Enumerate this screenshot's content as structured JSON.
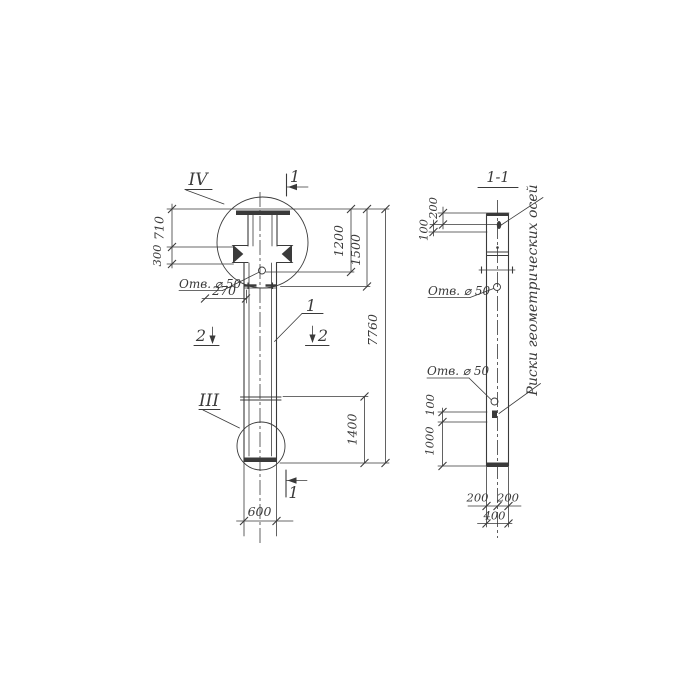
{
  "front_view": {
    "detail_marker_top": "IV",
    "detail_marker_bottom": "III",
    "section_cut_top": "1",
    "section_cut_bottom": "1",
    "section_cut_left": "2",
    "section_cut_right": "2",
    "part_mark": "1",
    "hole_label": "Отв. ⌀ 50",
    "dim_710": "710",
    "dim_300": "300",
    "dim_270": "270",
    "dim_1200": "1200",
    "dim_1500": "1500",
    "dim_7760": "7760",
    "dim_1400": "1400",
    "dim_600": "600"
  },
  "section_view": {
    "title": "1-1",
    "hole_label_upper": "Отв. ⌀ 50",
    "hole_label_lower": "Отв. ⌀ 50",
    "axes_note": "Риски геометрических осей",
    "dim_200_top": "200",
    "dim_100_top": "100",
    "dim_100_bottom": "100",
    "dim_1000": "1000",
    "dim_200_left": "200",
    "dim_200_right": "200",
    "dim_400": "400"
  },
  "colors": {
    "ink": "#3a3a3a",
    "paper": "#ffffff"
  }
}
